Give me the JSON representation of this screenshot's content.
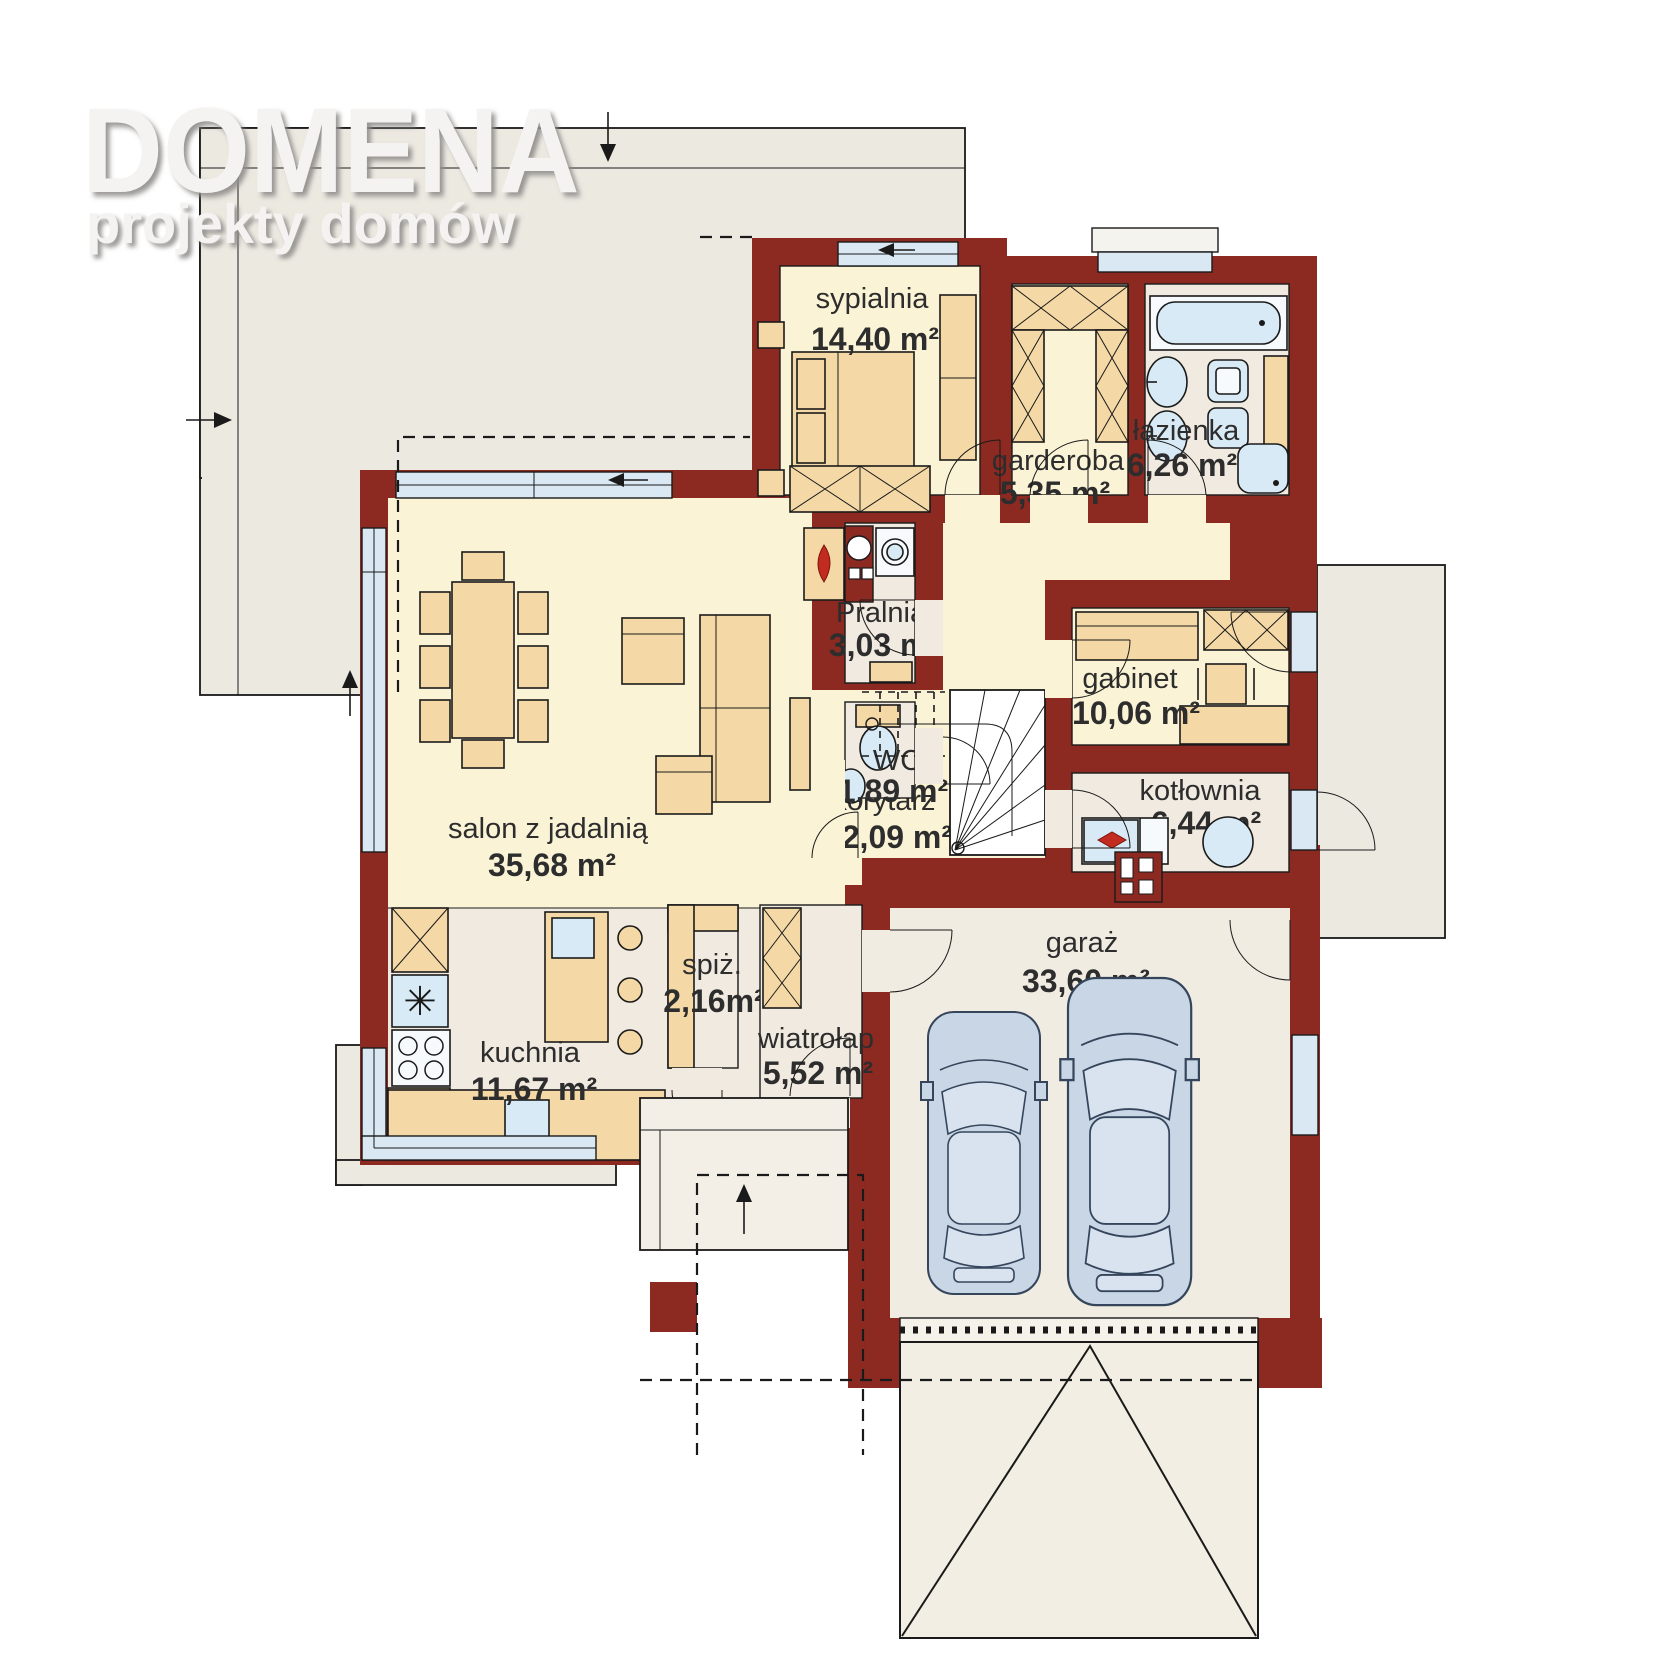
{
  "logo": {
    "title": "DOMENA",
    "subtitle": "projekty domów"
  },
  "colors": {
    "wall": "#8C2A22",
    "floor_cream": "#FAF3D6",
    "floor_neutral": "#F1EAE0",
    "garage_floor": "#F1ECE2",
    "furniture_tan": "#F4D9A6",
    "glass_blue": "#D9E8F3",
    "fixture_blue": "#D8EAF5",
    "terrace": "#ECE9E1",
    "car": "#C9D6E6",
    "flame": "#C22B1F",
    "text": "#2d2d2d"
  },
  "rooms": {
    "sypialnia": {
      "name": "sypialnia",
      "area": "14,40 m²"
    },
    "garderoba": {
      "name": "garderoba",
      "area": "5,35 m²"
    },
    "lazienka": {
      "name": "łazienka",
      "area": "6,26 m²"
    },
    "pralnia": {
      "name": "Pralnia",
      "area": "3,03 m²"
    },
    "gabinet": {
      "name": "gabinet",
      "area": "10,06 m²"
    },
    "wc": {
      "name": "WC",
      "area": "1,89 m²"
    },
    "kotlownia": {
      "name": "kotłownia",
      "area": "6,44 m²"
    },
    "salon": {
      "name": "salon z jadalnią",
      "area": "35,68 m²"
    },
    "korytarz": {
      "name": "korytarz",
      "area": "12,09 m²"
    },
    "kuchnia": {
      "name": "kuchnia",
      "area": "11,67 m²"
    },
    "spiz": {
      "name": "spiż.",
      "area": "2,16m²"
    },
    "wiatrolap": {
      "name": "wiatrołap",
      "area": "5,52 m²"
    },
    "garaz": {
      "name": "garaż",
      "area": "33,60 m²"
    }
  }
}
